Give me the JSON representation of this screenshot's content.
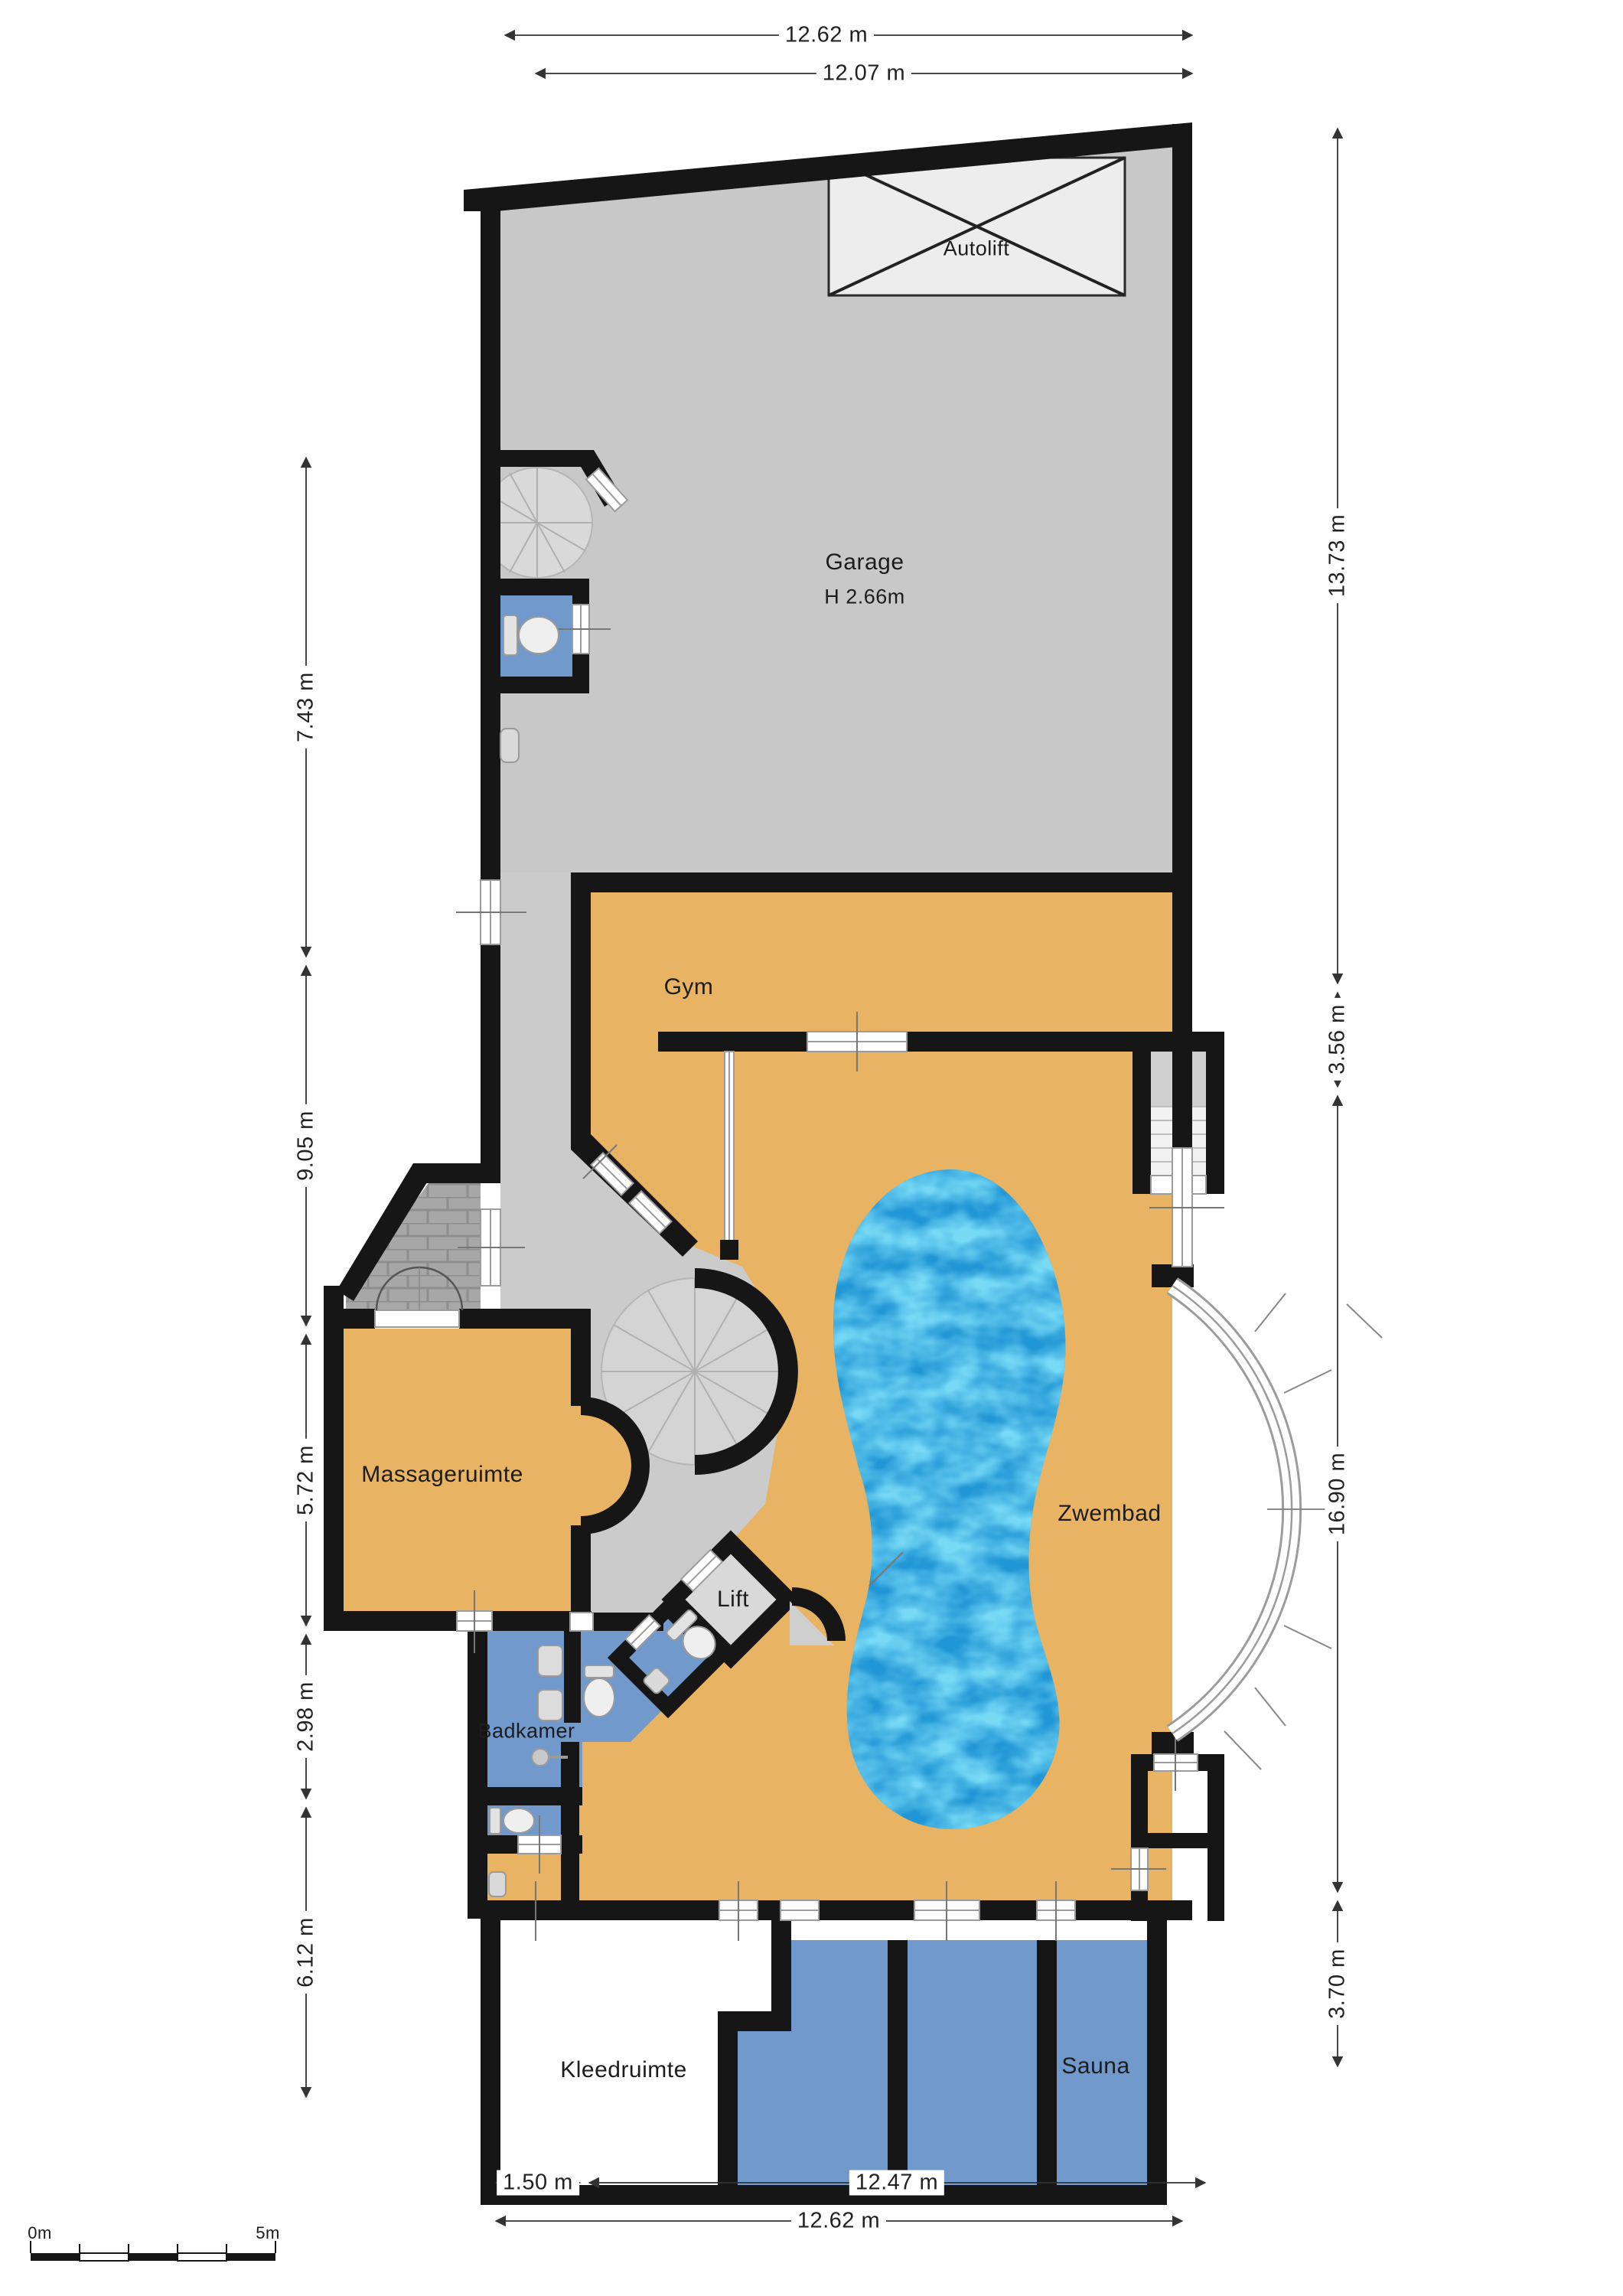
{
  "plan": {
    "rooms": {
      "autolift": {
        "label": "Autolift"
      },
      "garage": {
        "label": "Garage",
        "height_note": "H 2.66m"
      },
      "gym": {
        "label": "Gym"
      },
      "massageruimte": {
        "label": "Massageruimte"
      },
      "lift": {
        "label": "Lift"
      },
      "badkamer": {
        "label": "Badkamer"
      },
      "zwembad": {
        "label": "Zwembad"
      },
      "kleedruimte": {
        "label": "Kleedruimte"
      },
      "sauna": {
        "label": "Sauna"
      }
    },
    "dimensions": {
      "top": [
        "12.62 m",
        "12.07 m"
      ],
      "left": [
        "7.43 m",
        "9.05 m",
        "5.72 m",
        "2.98 m",
        "6.12 m"
      ],
      "right": [
        "13.73 m",
        "3.56 m",
        "16.90 m",
        "3.70 m"
      ],
      "bottom": [
        "1.50 m",
        "12.47 m",
        "12.62 m"
      ]
    },
    "scale_bar": {
      "start_label": "0m",
      "end_label": "5m"
    },
    "colors": {
      "wall": "#161616",
      "garage_floor": "#c8c8c8",
      "deck_floor": "#e8b362",
      "wet_room": "#7299cb",
      "hall_floor": "#cbcbcb",
      "pool_water": "#2196d6",
      "autolift_fill": "#ededed"
    }
  }
}
